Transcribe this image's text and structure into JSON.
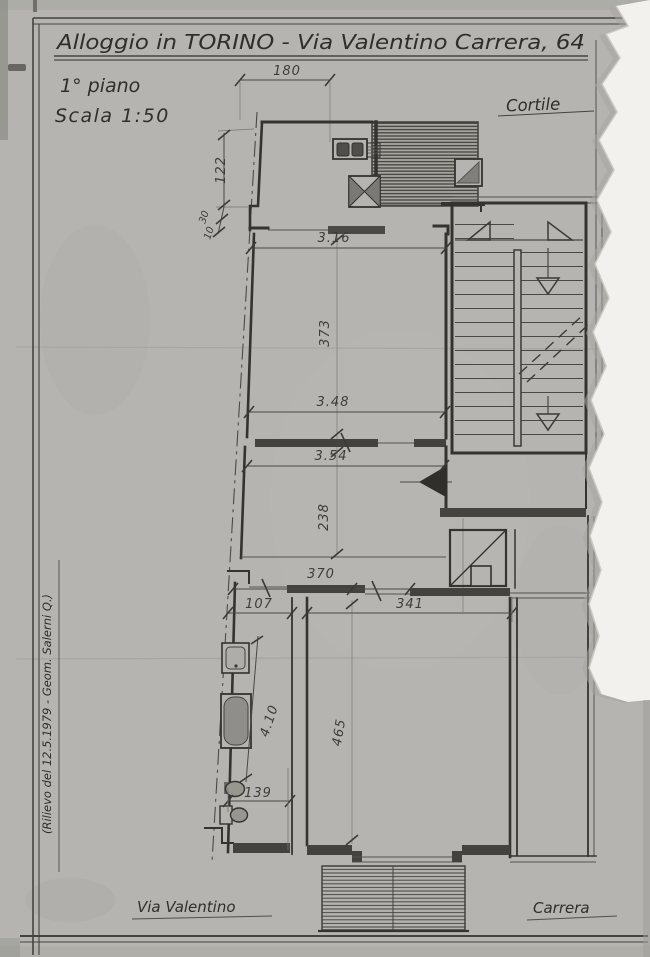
{
  "document": {
    "type": "floor-plan-survey-drawing",
    "title": "Alloggio in TORINO - Via Valentino Carrera, 64",
    "floor_label": "1° piano",
    "scale_label": "Scala 1:50",
    "courtyard_label": "Cortile",
    "street_label_left": "Via Valentino",
    "street_label_right": "Carrera",
    "survey_note": "(Rilievo del 12.5.1979 - Geom. Salerni Q.)"
  },
  "dimensions": {
    "balcony_width": "180",
    "kitchen_side": "122",
    "step_a": "30",
    "step_b": "10",
    "room1_top": "3.16",
    "room1_depth": "373",
    "room1_bottom": "3.48",
    "room2_top": "3.54",
    "room2_depth": "238",
    "hall_width": "370",
    "bath_door": "107",
    "room3_top": "341",
    "bath_depth": "4.10",
    "room3_depth": "465",
    "wc_width": "139"
  },
  "colors": {
    "paper": "#b5b4b0",
    "ink": "#2f2e2a",
    "pencil": "#4a4845",
    "torn_paper": "#f2f1ed"
  }
}
